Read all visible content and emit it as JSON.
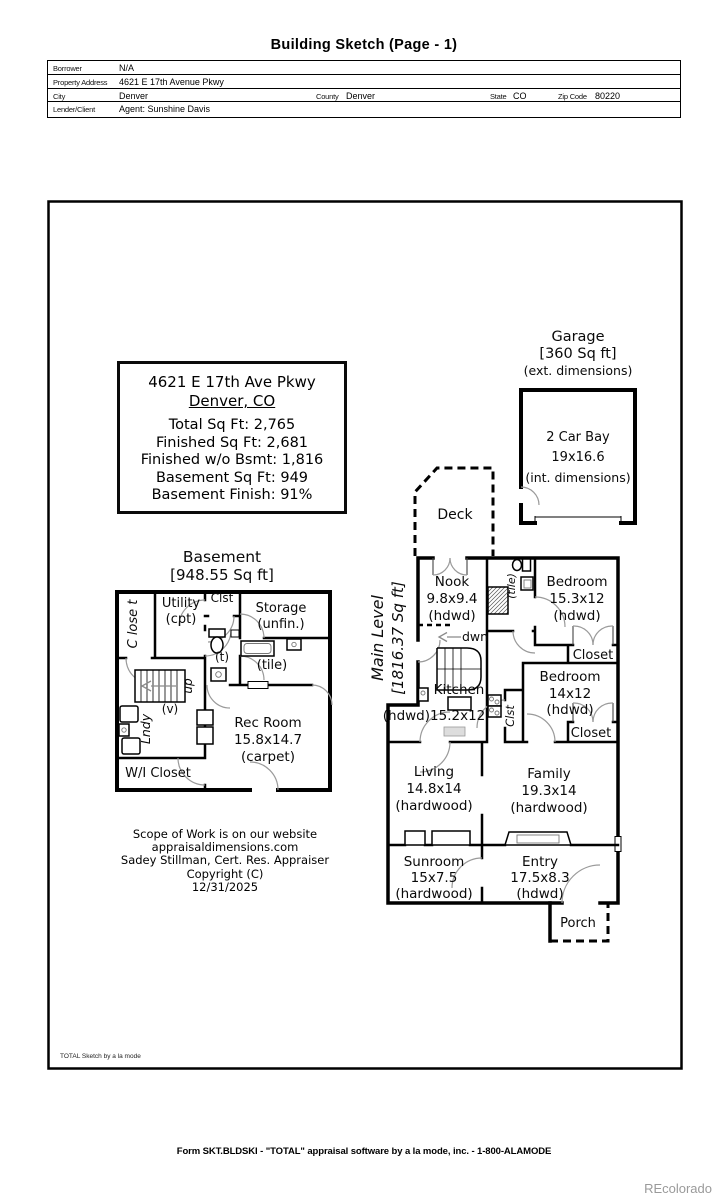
{
  "page": {
    "title": "Building Sketch (Page - 1)",
    "footer": "Form SKT.BLDSKI - \"TOTAL\" appraisal software by a la mode, inc. - 1-800-ALAMODE",
    "watermark": "REcolorado",
    "sketch_credit": "TOTAL Sketch by a la mode"
  },
  "header_form": {
    "borrower_label": "Borrower",
    "borrower": "N/A",
    "property_address_label": "Property Address",
    "property_address": "4621 E 17th Avenue Pkwy",
    "city_label": "City",
    "city": "Denver",
    "county_label": "County",
    "county": "Denver",
    "state_label": "State",
    "state": "CO",
    "zip_label": "Zip Code",
    "zip": "80220",
    "lender_label": "Lender/Client",
    "lender": "Agent: Sunshine Davis"
  },
  "summary_box": {
    "address": "4621 E 17th Ave Pkwy",
    "city_state": "Denver, CO",
    "total": "Total Sq Ft: 2,765",
    "finished": "Finished Sq Ft: 2,681",
    "finished_wo_bsmt": "Finished w/o Bsmt: 1,816",
    "basement_sqft": "Basement Sq Ft: 949",
    "basement_finish": "Basement Finish: 91%"
  },
  "garage": {
    "title": "Garage",
    "area": "[360 Sq ft]",
    "ext_note": "(ext. dimensions)",
    "bay": "2 Car Bay",
    "bay_dims": "19x16.6",
    "int_note": "(int. dimensions)"
  },
  "basement": {
    "title": "Basement",
    "area": "[948.55 Sq ft]",
    "closet_vert": "C lose t",
    "utility": "Utility",
    "utility_floor": "(cpt)",
    "clst": "Clst",
    "storage": "Storage",
    "storage_note": "(unfin.)",
    "toilet_room": "(t)",
    "tile": "(tile)",
    "up": "up",
    "vanity": "(v)",
    "laundry": "Lndy",
    "wi_closet": "W/I Closet",
    "rec_room": "Rec Room",
    "rec_dims": "15.8x14.7",
    "rec_floor": "(carpet)"
  },
  "main_level": {
    "title": "Main Level",
    "area": "[1816.37 Sq ft]",
    "deck": "Deck",
    "nook": "Nook",
    "nook_dims": "9.8x9.4",
    "nook_floor": "(hdwd)",
    "down": "dwn",
    "tile": "(tile)",
    "bedroom1": "Bedroom",
    "bedroom1_dims": "15.3x12",
    "bedroom1_floor": "(hdwd)",
    "closet1": "Closet",
    "bedroom2": "Bedroom",
    "bedroom2_dims": "14x12",
    "bedroom2_floor": "(hdwd)",
    "closet2": "Closet",
    "clst": "Clst",
    "kitchen": "Kitchen",
    "kitchen_dims": "(hdwd)15.2x12",
    "living": "Living",
    "living_dims": "14.8x14",
    "living_floor": "(hardwood)",
    "family": "Family",
    "family_dims": "19.3x14",
    "family_floor": "(hardwood)",
    "sunroom": "Sunroom",
    "sunroom_dims": "15x7.5",
    "sunroom_floor": "(hardwood)",
    "entry": "Entry",
    "entry_dims": "17.5x8.3",
    "entry_floor": "(hdwd)",
    "porch": "Porch"
  },
  "scope": {
    "line1": "Scope of Work is on our website",
    "line2": "appraisaldimensions.com",
    "line3": "Sadey Stillman, Cert. Res. Appraiser",
    "line4": "Copyright (C)",
    "line5": "12/31/2025"
  }
}
